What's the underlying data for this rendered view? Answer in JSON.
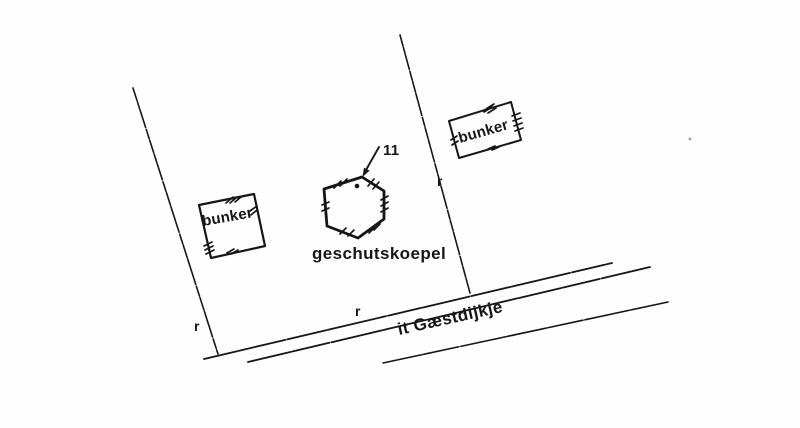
{
  "map": {
    "colors": {
      "ink": "#161616",
      "paper": "#fefefe"
    },
    "labels": {
      "bunker_left": "bunker",
      "bunker_right": "bunker",
      "gun_turret": "geschutskoepel",
      "road_name": "it Gæstdijkje",
      "turret_number": "11",
      "marker_left": "r",
      "marker_middle": "r",
      "marker_right": "r"
    }
  }
}
